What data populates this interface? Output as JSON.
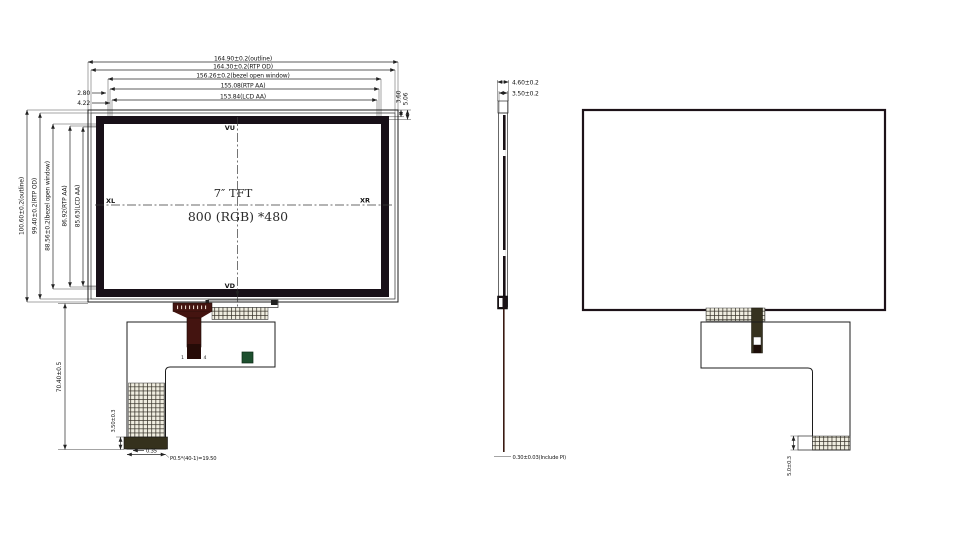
{
  "front_view": {
    "dims_top": [
      "164.90±0.2(outline)",
      "164.30±0.2(RTP OD)",
      "156.26±0.2(bezel open window)",
      "155.08(RTP AA)",
      "153.84(LCD AA)"
    ],
    "dims_left": [
      "100.60±0.2(outline)",
      "99.40±0.2(RTP OD)",
      "88.56±0.2(bezel open window)",
      "86.92(RTP AA)",
      "85.63(LCD AA)"
    ],
    "dim_edge_top_left_a": "2.80",
    "dim_edge_top_left_b": "4.22",
    "dim_edge_top_right_a": "3.60",
    "dim_edge_top_right_b": "5.06",
    "centerline": {
      "top": "VU",
      "bottom": "VD",
      "left": "XL",
      "right": "XR"
    },
    "screen_title": "7″  TFT",
    "screen_resolution": "800 (RGB) *480",
    "dim_fpc_length": "70.40±0.5",
    "dim_fpc_stiffener": "3.50±0.3",
    "dim_fpc_offset": "0.35",
    "fpc_pitch_note": "P0.5*(40-1)=19.50",
    "pin_first": "1",
    "pin_last": "4"
  },
  "side_view": {
    "dim_total_thickness": "4.60±0.2",
    "dim_lcd_thickness": "3.50±0.2",
    "dim_fpc_thickness": "0.30±0.03(Include PI)"
  },
  "rear_view": {
    "dim_connector": "5.0±0.3"
  },
  "colors": {
    "bezel": "#181018",
    "fpc_tail": "#441410",
    "fpc_tail_dark": "#260b07",
    "stiffener": "#35311d",
    "component_green": "#1d4f2e",
    "connector_strip": "#36321f"
  }
}
